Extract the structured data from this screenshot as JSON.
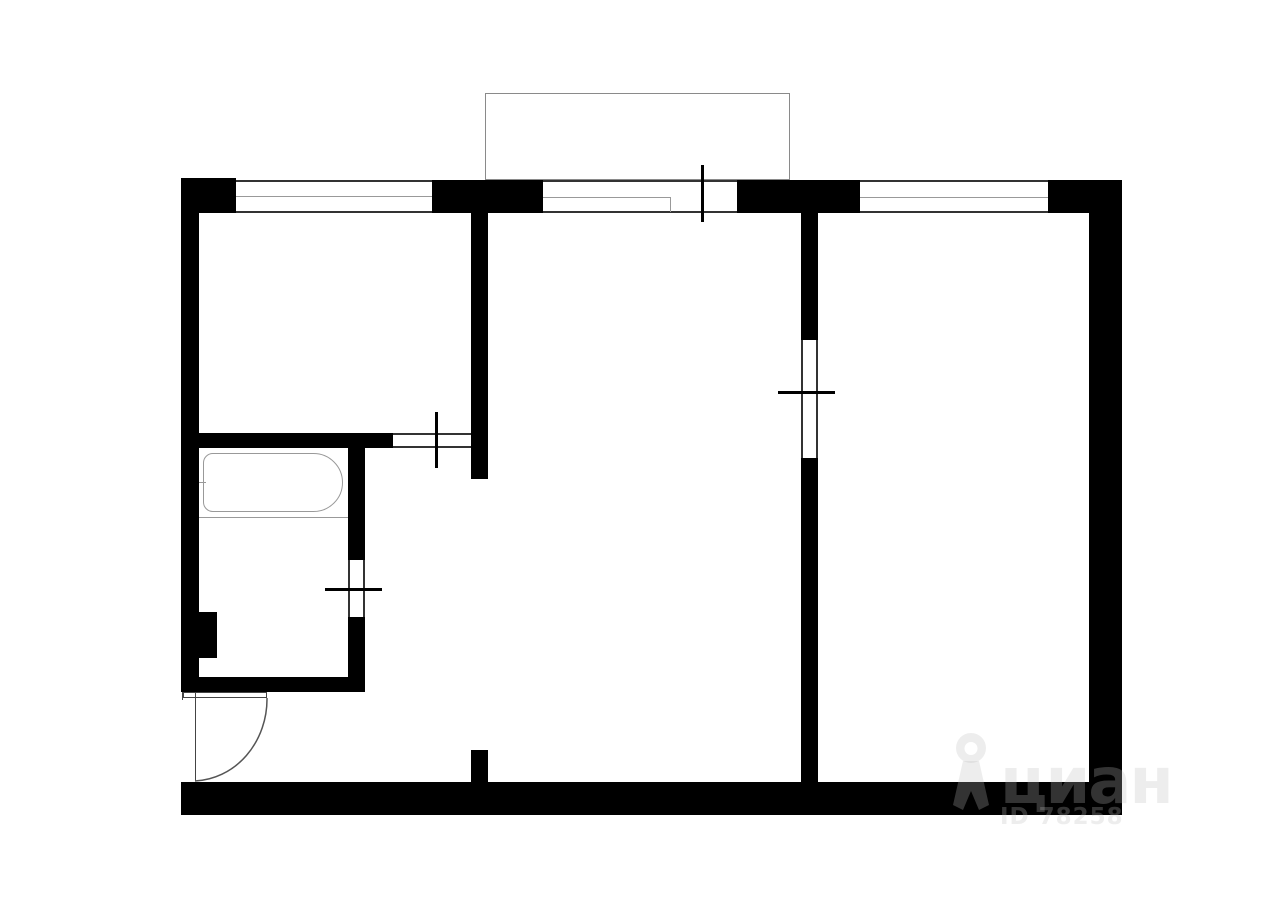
{
  "watermark": {
    "brand": "циан",
    "listing_id": "ID 78258",
    "watermark_color": "rgba(190,190,190,0.27)",
    "pin_icon": {
      "viewBox": "0 0 46 80",
      "paths": [
        "M23 2 A15 15 0 1 0 23 32 A15 15 0 1 0 23 2 Z M23 11 A6.5 6.5 0 1 1 23 24 A6.5 6.5 0 1 1 23 11 Z",
        "M15 30 L5 74 L15 79 L23 60 L31 79 L41 74 L31 30 Z"
      ]
    }
  },
  "floorplan": {
    "canvas": {
      "width": 1280,
      "height": 905,
      "background": "#ffffff"
    },
    "colors": {
      "wall": "#000000",
      "frame": "#333333",
      "light": "#999999"
    },
    "solids": [
      {
        "name": "top-left-corner-block",
        "x": 181,
        "y": 178,
        "w": 55,
        "h": 35
      },
      {
        "name": "top-wall-segment-2",
        "x": 432,
        "y": 180,
        "w": 111,
        "h": 33
      },
      {
        "name": "top-wall-segment-3",
        "x": 737,
        "y": 180,
        "w": 123,
        "h": 33
      },
      {
        "name": "top-right-corner-block",
        "x": 1048,
        "y": 180,
        "w": 74,
        "h": 33
      },
      {
        "name": "left-outer-wall",
        "x": 181,
        "y": 178,
        "w": 18,
        "h": 514
      },
      {
        "name": "right-outer-wall",
        "x": 1089,
        "y": 180,
        "w": 33,
        "h": 635
      },
      {
        "name": "bottom-outer-wall",
        "x": 181,
        "y": 782,
        "w": 941,
        "h": 33
      },
      {
        "name": "partition-room1-hall",
        "x": 471,
        "y": 213,
        "w": 17,
        "h": 266
      },
      {
        "name": "partition-room1-bathroom",
        "x": 181,
        "y": 433,
        "w": 212,
        "h": 15
      },
      {
        "name": "partition-bathroom-right-upper",
        "x": 348,
        "y": 448,
        "w": 17,
        "h": 112
      },
      {
        "name": "partition-bathroom-right-lower",
        "x": 348,
        "y": 617,
        "w": 17,
        "h": 75
      },
      {
        "name": "partition-bathroom-bottom",
        "x": 181,
        "y": 677,
        "w": 184,
        "h": 15
      },
      {
        "name": "duct-pilaster",
        "x": 199,
        "y": 612,
        "w": 18,
        "h": 46
      },
      {
        "name": "partition-rooms-divider-upper",
        "x": 801,
        "y": 213,
        "w": 17,
        "h": 127
      },
      {
        "name": "partition-rooms-divider-lower",
        "x": 801,
        "y": 458,
        "w": 17,
        "h": 324
      },
      {
        "name": "hall-stub-wall",
        "x": 471,
        "y": 750,
        "w": 17,
        "h": 32
      }
    ],
    "outlines": [
      {
        "name": "balcony-outline",
        "x": 485,
        "y": 93,
        "w": 305,
        "h": 87,
        "border": "#8a8a8a"
      },
      {
        "name": "bathtub",
        "x": 203,
        "y": 453,
        "w": 140,
        "h": 59,
        "border": "#999999",
        "radius": "10px 30px 30px 10px"
      },
      {
        "name": "entry-door-leaf",
        "x": 183,
        "y": 692,
        "w": 84,
        "h": 6,
        "border": "#444444"
      }
    ],
    "lines": [
      {
        "name": "window-left-top-line",
        "x": 236,
        "y": 180,
        "w": 196,
        "h": 2
      },
      {
        "name": "window-left-mid-line",
        "x": 236,
        "y": 196,
        "w": 196,
        "h": 1,
        "color": "#999999"
      },
      {
        "name": "window-left-bottom-line",
        "x": 236,
        "y": 211,
        "w": 196,
        "h": 2
      },
      {
        "name": "window-mid-top-line",
        "x": 543,
        "y": 180,
        "w": 128,
        "h": 2
      },
      {
        "name": "window-mid-mid-line",
        "x": 543,
        "y": 197,
        "w": 128,
        "h": 1,
        "color": "#999999"
      },
      {
        "name": "window-mid-bottom-line",
        "x": 543,
        "y": 211,
        "w": 128,
        "h": 2
      },
      {
        "name": "window-mid-end-line",
        "x": 670,
        "y": 197,
        "w": 1,
        "h": 15,
        "color": "#999999"
      },
      {
        "name": "balcony-door-top-line",
        "x": 671,
        "y": 180,
        "w": 66,
        "h": 2
      },
      {
        "name": "balcony-door-bottom-line",
        "x": 671,
        "y": 211,
        "w": 66,
        "h": 2
      },
      {
        "name": "balcony-door-tick",
        "x": 701,
        "y": 165,
        "w": 3,
        "h": 57,
        "color": "#000000"
      },
      {
        "name": "window-right-top-line",
        "x": 860,
        "y": 180,
        "w": 188,
        "h": 2
      },
      {
        "name": "window-right-mid-line",
        "x": 860,
        "y": 197,
        "w": 188,
        "h": 1,
        "color": "#999999"
      },
      {
        "name": "window-right-bottom-line",
        "x": 860,
        "y": 211,
        "w": 188,
        "h": 2
      },
      {
        "name": "door-room1-top-line",
        "x": 393,
        "y": 433,
        "w": 78,
        "h": 2
      },
      {
        "name": "door-room1-bottom-line",
        "x": 393,
        "y": 446,
        "w": 78,
        "h": 2
      },
      {
        "name": "door-room1-tick",
        "x": 435,
        "y": 412,
        "w": 3,
        "h": 56,
        "color": "#000000"
      },
      {
        "name": "door-bathroom-left-line",
        "x": 348,
        "y": 560,
        "w": 2,
        "h": 57
      },
      {
        "name": "door-bathroom-right-line",
        "x": 363,
        "y": 560,
        "w": 2,
        "h": 57
      },
      {
        "name": "door-bathroom-tick",
        "x": 325,
        "y": 588,
        "w": 57,
        "h": 3,
        "color": "#000000"
      },
      {
        "name": "door-room2-left-line",
        "x": 801,
        "y": 340,
        "w": 2,
        "h": 118
      },
      {
        "name": "door-room2-right-line",
        "x": 816,
        "y": 340,
        "w": 2,
        "h": 118
      },
      {
        "name": "door-room2-tick",
        "x": 778,
        "y": 391,
        "w": 57,
        "h": 3,
        "color": "#000000"
      },
      {
        "name": "bathtub-shelf-line",
        "x": 199,
        "y": 517,
        "w": 149,
        "h": 1,
        "color": "#999999"
      },
      {
        "name": "bathtub-faucet-tick",
        "x": 196,
        "y": 482,
        "w": 10,
        "h": 1,
        "color": "#999999"
      },
      {
        "name": "entry-door-jamb-line",
        "x": 195,
        "y": 692,
        "w": 1,
        "h": 89,
        "color": "#444444"
      },
      {
        "name": "entry-opening-edge-tick",
        "x": 182,
        "y": 692,
        "w": 1,
        "h": 8,
        "color": "#444444"
      }
    ],
    "arcs": [
      {
        "name": "entry-door-swing-arc",
        "d": "M 267 698 A 75 82 0 0 1 195 781",
        "stroke": "#555555"
      }
    ]
  }
}
